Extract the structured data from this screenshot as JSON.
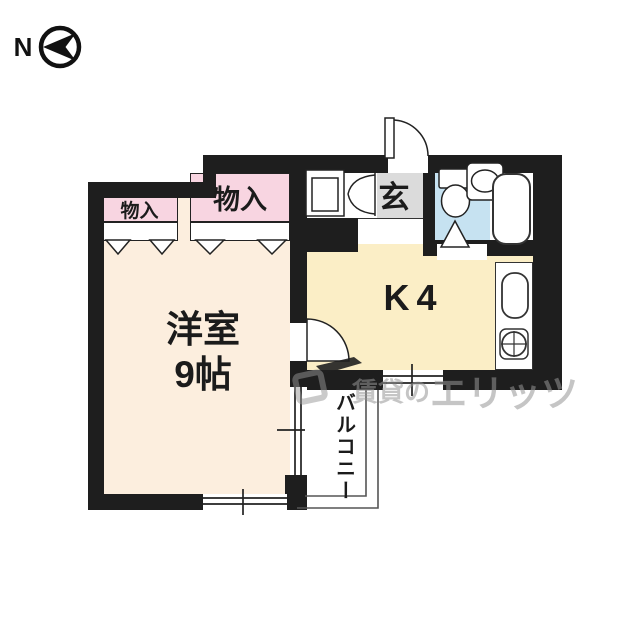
{
  "compass": {
    "label": "N"
  },
  "plan": {
    "rooms": {
      "western_room": {
        "line1": "洋室",
        "line2": "9帖"
      },
      "kitchen": {
        "label": "K4"
      },
      "genkan": {
        "label": "玄"
      },
      "balcony": {
        "label": "バルコニー"
      }
    },
    "closets": {
      "small": {
        "label": "物入"
      },
      "large": {
        "label": "物入"
      }
    },
    "fixtures": [
      "toilet",
      "bathtub",
      "wash-basin",
      "kitchen-sink",
      "gas-burner",
      "washer-pan"
    ]
  },
  "watermark": {
    "part1": "賃貸の",
    "part2": "エリッツ"
  },
  "colors": {
    "wall": "#1e1e1e",
    "western_room_fill": "#fceede",
    "closet_fill": "#f8d5e1",
    "kitchen_fill": "#fbeec6",
    "genkan_fill": "#dbdbdb",
    "bath_fill": "#c6e2f1",
    "watermark_gray": "#9b9b9b"
  }
}
